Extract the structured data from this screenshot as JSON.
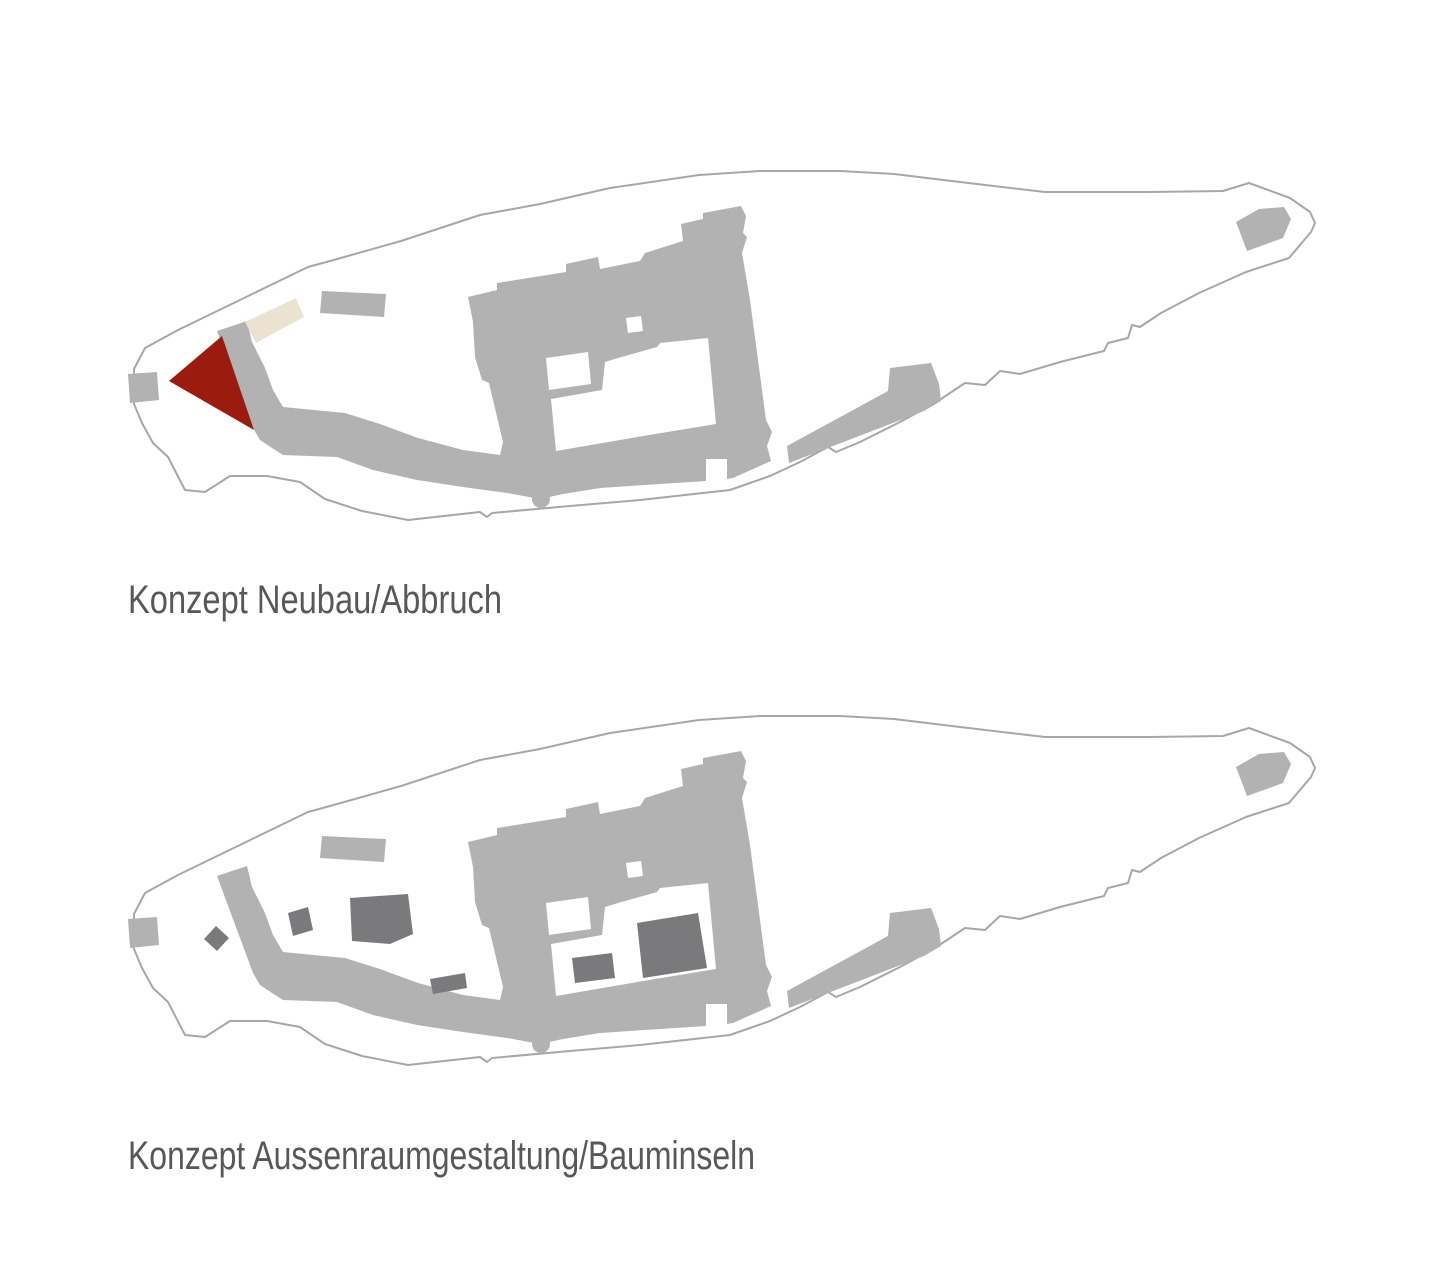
{
  "colors": {
    "background": "#FFFFFF",
    "building": "#B2B2B3",
    "island": "#7A7A7C",
    "neubau": "#9C1B0F",
    "abbruch": "#EBE2D1",
    "outline": "#A7A7A9",
    "caption": "#58585B"
  },
  "diagrams": [
    {
      "id": "neubau-abbruch",
      "caption": "Konzept Neubau/Abbruch",
      "markers": [
        {
          "name": "neubau-wedge",
          "color": "#9C1B0F"
        },
        {
          "name": "abbruch-area",
          "color": "#EBE2D1"
        }
      ]
    },
    {
      "id": "aussenraumgestaltung-bauminseln",
      "caption": "Konzept Aussenraumgestaltung/Bauminseln",
      "tree_island_count": 6
    }
  ]
}
